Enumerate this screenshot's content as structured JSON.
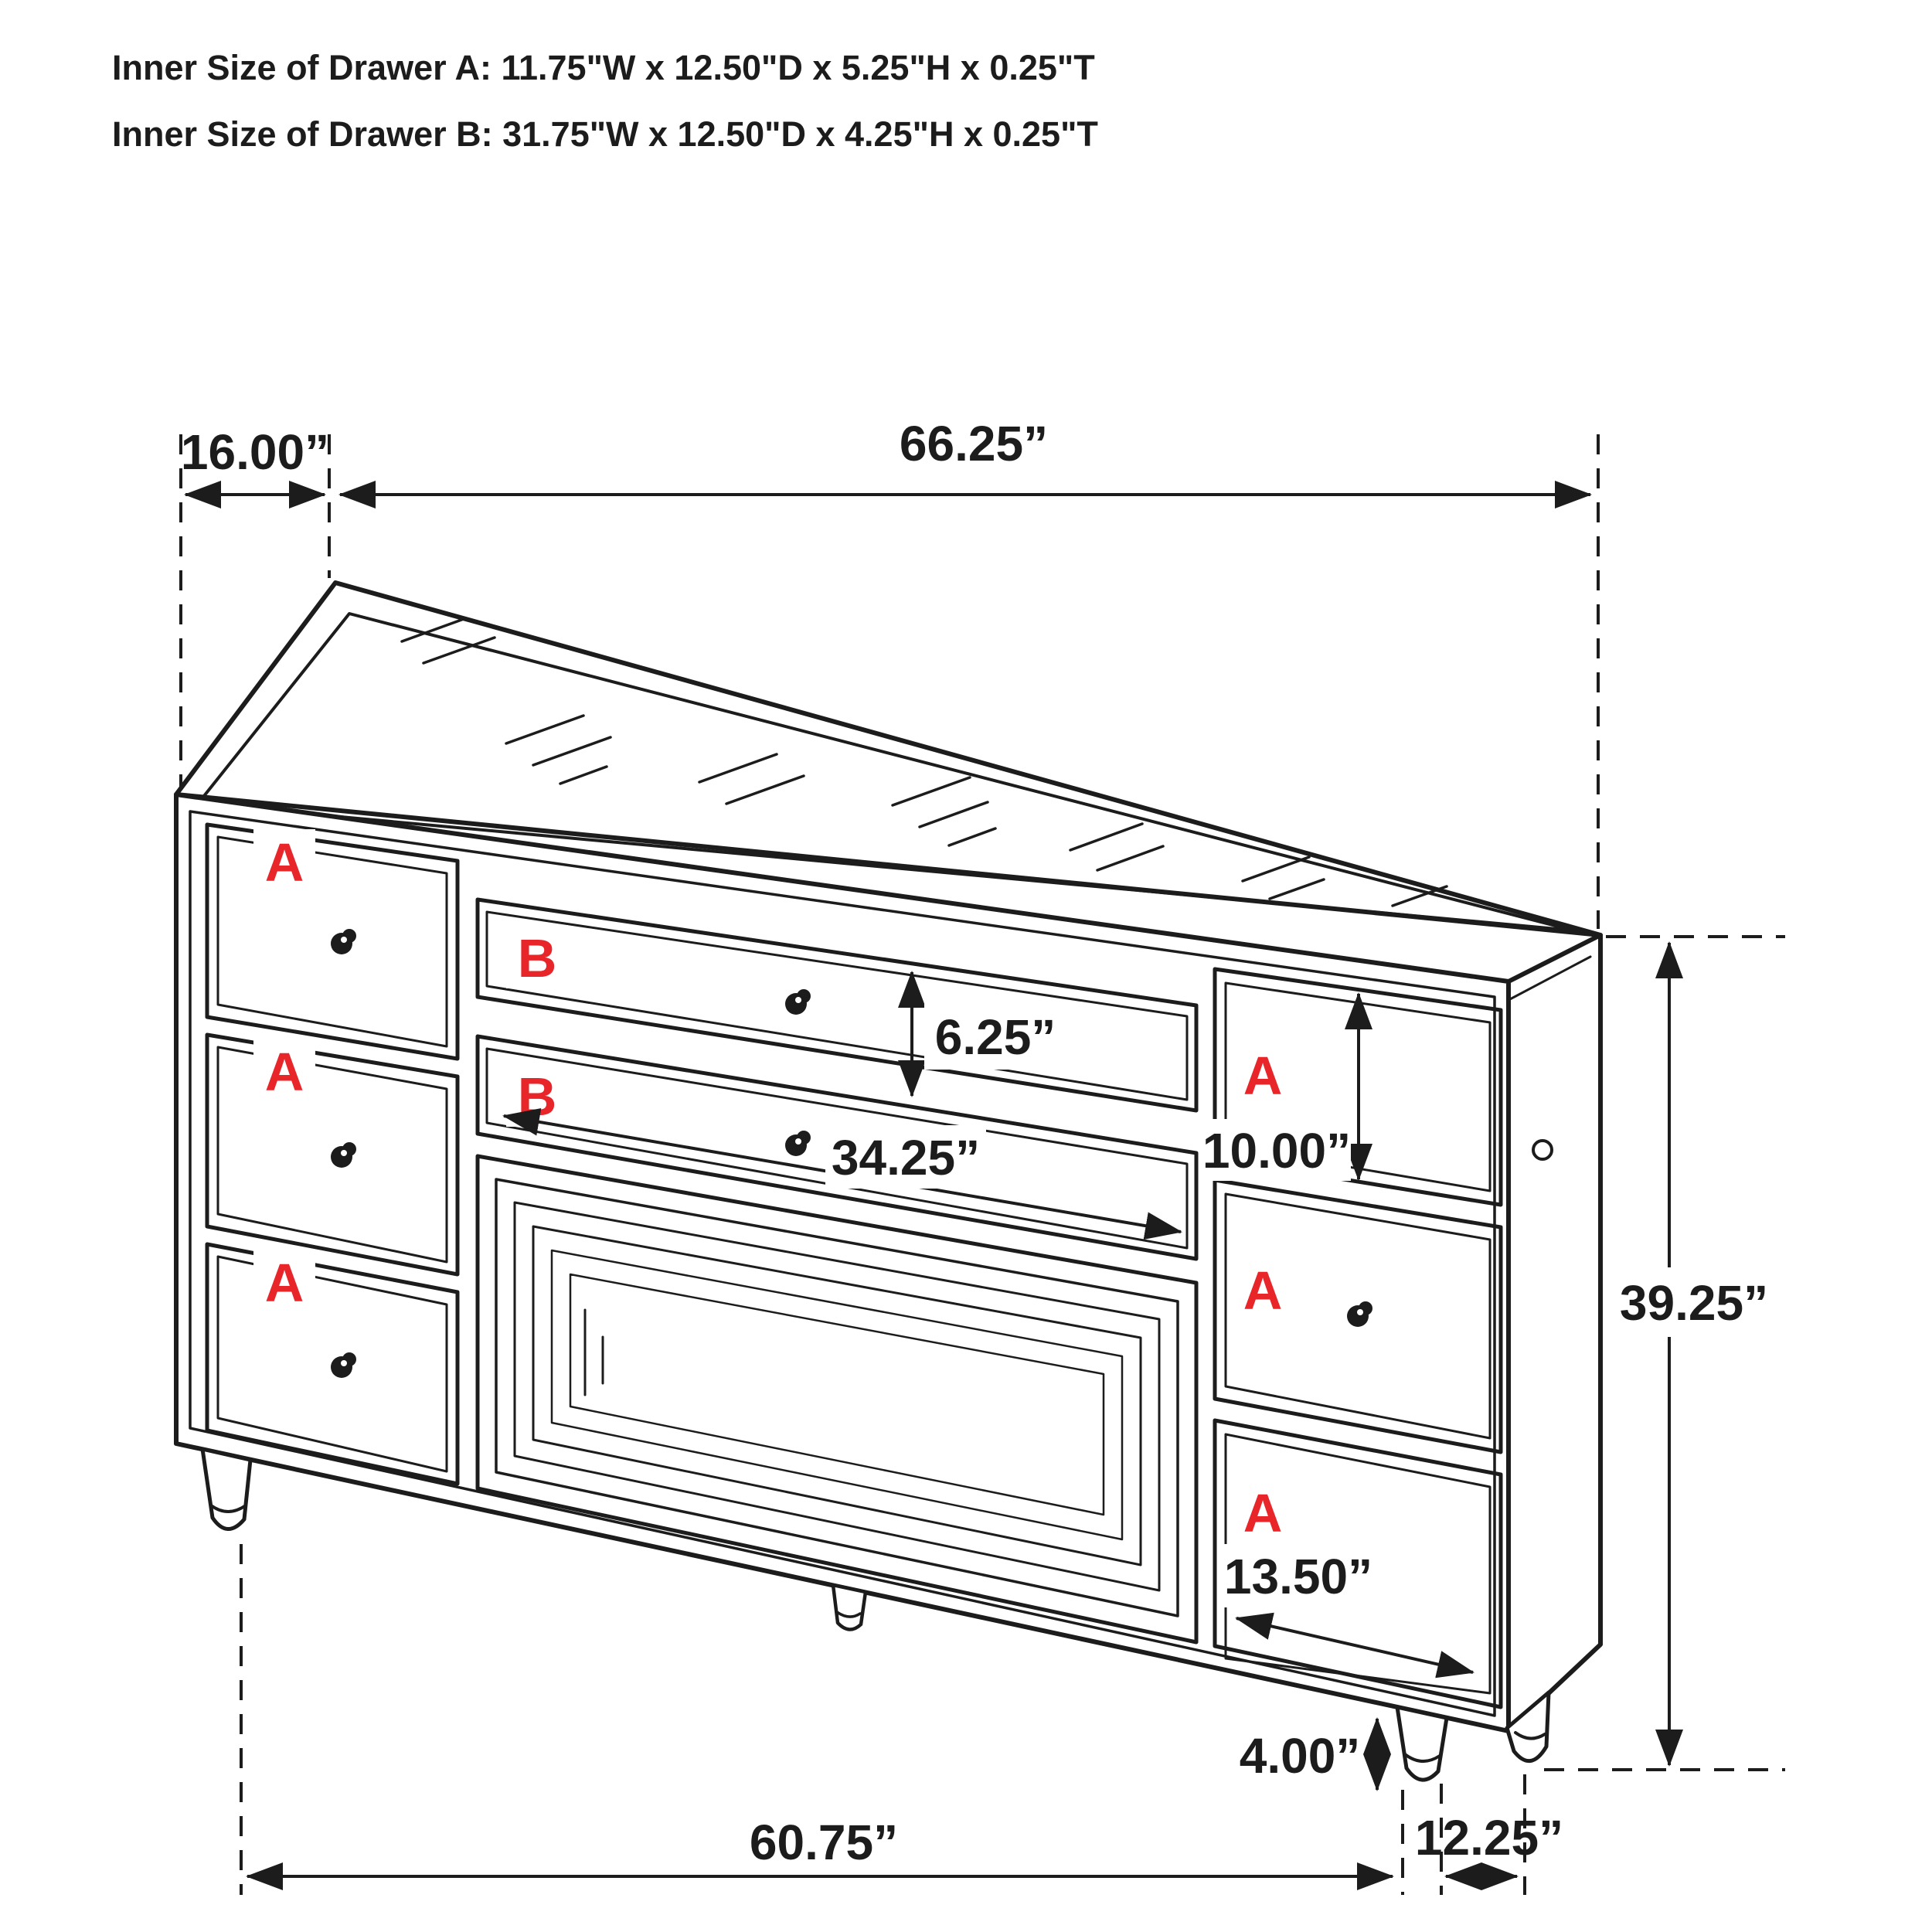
{
  "title": {
    "line1": "Inner Size of Drawer A: 11.75\"W x 12.50\"D x 5.25\"H x 0.25\"T",
    "line2": "Inner Size of Drawer B: 31.75\"W x 12.50\"D x 4.25\"H x 0.25\"T"
  },
  "dimensions": {
    "top_depth": "16.00”",
    "top_width": "66.25”",
    "b_drawer_height": "6.25”",
    "b_drawer_width": "34.25”",
    "right_top_drawer_height": "10.00”",
    "overall_height": "39.25”",
    "right_bottom_drawer_width": "13.50”",
    "foot_height": "4.00”",
    "front_width_at_feet": "60.75”",
    "side_depth_at_feet": "12.25”"
  },
  "drawer_labels": {
    "left": [
      "A",
      "A",
      "A"
    ],
    "middle": [
      "B",
      "B"
    ],
    "right": [
      "A",
      "A",
      "A"
    ]
  },
  "colors": {
    "line": "#1c1c1c",
    "label_red": "#e8262a",
    "background": "#ffffff"
  }
}
